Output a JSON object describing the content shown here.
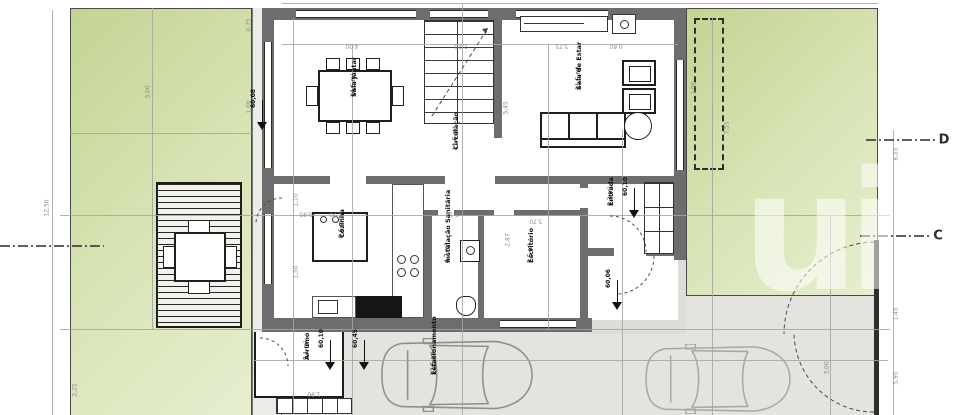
{
  "plan_type": "architectural-floor-plan-ground-floor",
  "colors": {
    "garden_green_dark": "#c3d493",
    "garden_green_light": "#e6eecf",
    "wall_gray": "#6d6d6d",
    "path_gray": "#ecebe6",
    "driveway_gray": "#e4e3df",
    "dimension_gray": "#a5a5a1",
    "ink_black": "#1f1f1d"
  },
  "watermark": {
    "text": "ui"
  },
  "rooms": [
    {
      "id": "sala-jantar",
      "label": "Sala Jantar",
      "area": "14,6 m²",
      "x": 350,
      "y": 97
    },
    {
      "id": "sala-estar",
      "label": "Sala de Estar",
      "area": "21,5 m²",
      "x": 575,
      "y": 90
    },
    {
      "id": "circulacao",
      "label": "Circulação",
      "area": "11,6 m²",
      "x": 452,
      "y": 150
    },
    {
      "id": "cozinha",
      "label": "Cozinha",
      "area": "9,6 m²",
      "x": 338,
      "y": 238
    },
    {
      "id": "inst-sanitaria",
      "label": "Instalação Sanitária",
      "area": "4,7 m²",
      "x": 444,
      "y": 263
    },
    {
      "id": "escritorio",
      "label": "Escritório",
      "area": "7,5 m²",
      "x": 527,
      "y": 263
    },
    {
      "id": "entrada",
      "label": "Entrada",
      "area": "5,3 m²",
      "x": 607,
      "y": 206
    },
    {
      "id": "arrumo",
      "label": "Arrumo",
      "area": "5,1 m²",
      "x": 303,
      "y": 360
    },
    {
      "id": "estacionamento",
      "label": "Estacionamento",
      "area": "12,5 m²",
      "x": 430,
      "y": 375
    }
  ],
  "levels": [
    {
      "value": "60,08",
      "x": 262,
      "y": 112
    },
    {
      "value": "60,10",
      "x": 634,
      "y": 200
    },
    {
      "value": "60,10",
      "x": 330,
      "y": 352
    },
    {
      "value": "60,45",
      "x": 364,
      "y": 352
    },
    {
      "value": "60,06",
      "x": 617,
      "y": 292
    }
  ],
  "dimensions": [
    {
      "value": "4,00",
      "x": 352,
      "y": 46,
      "rot": 180
    },
    {
      "value": "2,20",
      "x": 461,
      "y": 46,
      "rot": 180
    },
    {
      "value": "3,75",
      "x": 562,
      "y": 46,
      "rot": 180
    },
    {
      "value": "0,60",
      "x": 616,
      "y": 46,
      "rot": 180
    },
    {
      "value": "5,45",
      "x": 506,
      "y": 108,
      "rot": -90
    },
    {
      "value": "3,00",
      "x": 148,
      "y": 92,
      "rot": -90
    },
    {
      "value": "12,50",
      "x": 47,
      "y": 208,
      "rot": -90
    },
    {
      "value": "0,75",
      "x": 249,
      "y": 25,
      "rot": -90
    },
    {
      "value": "1,00",
      "x": 249,
      "y": 107,
      "rot": -90
    },
    {
      "value": "7,55",
      "x": 727,
      "y": 128,
      "rot": -90
    },
    {
      "value": "1,00",
      "x": 694,
      "y": 88,
      "rot": -90
    },
    {
      "value": "8,55",
      "x": 896,
      "y": 154,
      "rot": -90
    },
    {
      "value": "1,45",
      "x": 896,
      "y": 314,
      "rot": -90
    },
    {
      "value": "5,95",
      "x": 896,
      "y": 378,
      "rot": -90
    },
    {
      "value": "1,10",
      "x": 296,
      "y": 200,
      "rot": -90
    },
    {
      "value": "2,13",
      "x": 452,
      "y": 214,
      "rot": 180
    },
    {
      "value": "3,70",
      "x": 536,
      "y": 221,
      "rot": 180
    },
    {
      "value": "2,87",
      "x": 508,
      "y": 240,
      "rot": -90
    },
    {
      "value": "0,95",
      "x": 306,
      "y": 214,
      "rot": 180
    },
    {
      "value": "1,70",
      "x": 336,
      "y": 214,
      "rot": 180
    },
    {
      "value": "1,50",
      "x": 296,
      "y": 272,
      "rot": -90
    },
    {
      "value": "1,90",
      "x": 314,
      "y": 394,
      "rot": 180
    },
    {
      "value": "3,00",
      "x": 827,
      "y": 368,
      "rot": -90
    },
    {
      "value": "2,25",
      "x": 75,
      "y": 390,
      "rot": -90
    }
  ],
  "sections": [
    {
      "letter": "D",
      "x": 944,
      "y": 140
    },
    {
      "letter": "C",
      "x": 938,
      "y": 236
    }
  ],
  "layout_lines": {
    "h": [
      [
        282,
        44,
        396
      ],
      [
        60,
        215,
        830
      ],
      [
        60,
        329,
        830
      ],
      [
        252,
        360,
        636
      ],
      [
        70,
        133,
        182
      ],
      [
        282,
        3,
        596
      ]
    ],
    "v": [
      [
        152,
        8,
        322
      ],
      [
        293,
        18,
        397
      ],
      [
        352,
        44,
        371
      ],
      [
        462,
        3,
        412
      ],
      [
        548,
        44,
        286
      ],
      [
        622,
        130,
        285
      ],
      [
        712,
        18,
        397
      ],
      [
        830,
        215,
        200
      ],
      [
        52,
        10,
        405
      ],
      [
        893,
        130,
        285
      ]
    ]
  }
}
